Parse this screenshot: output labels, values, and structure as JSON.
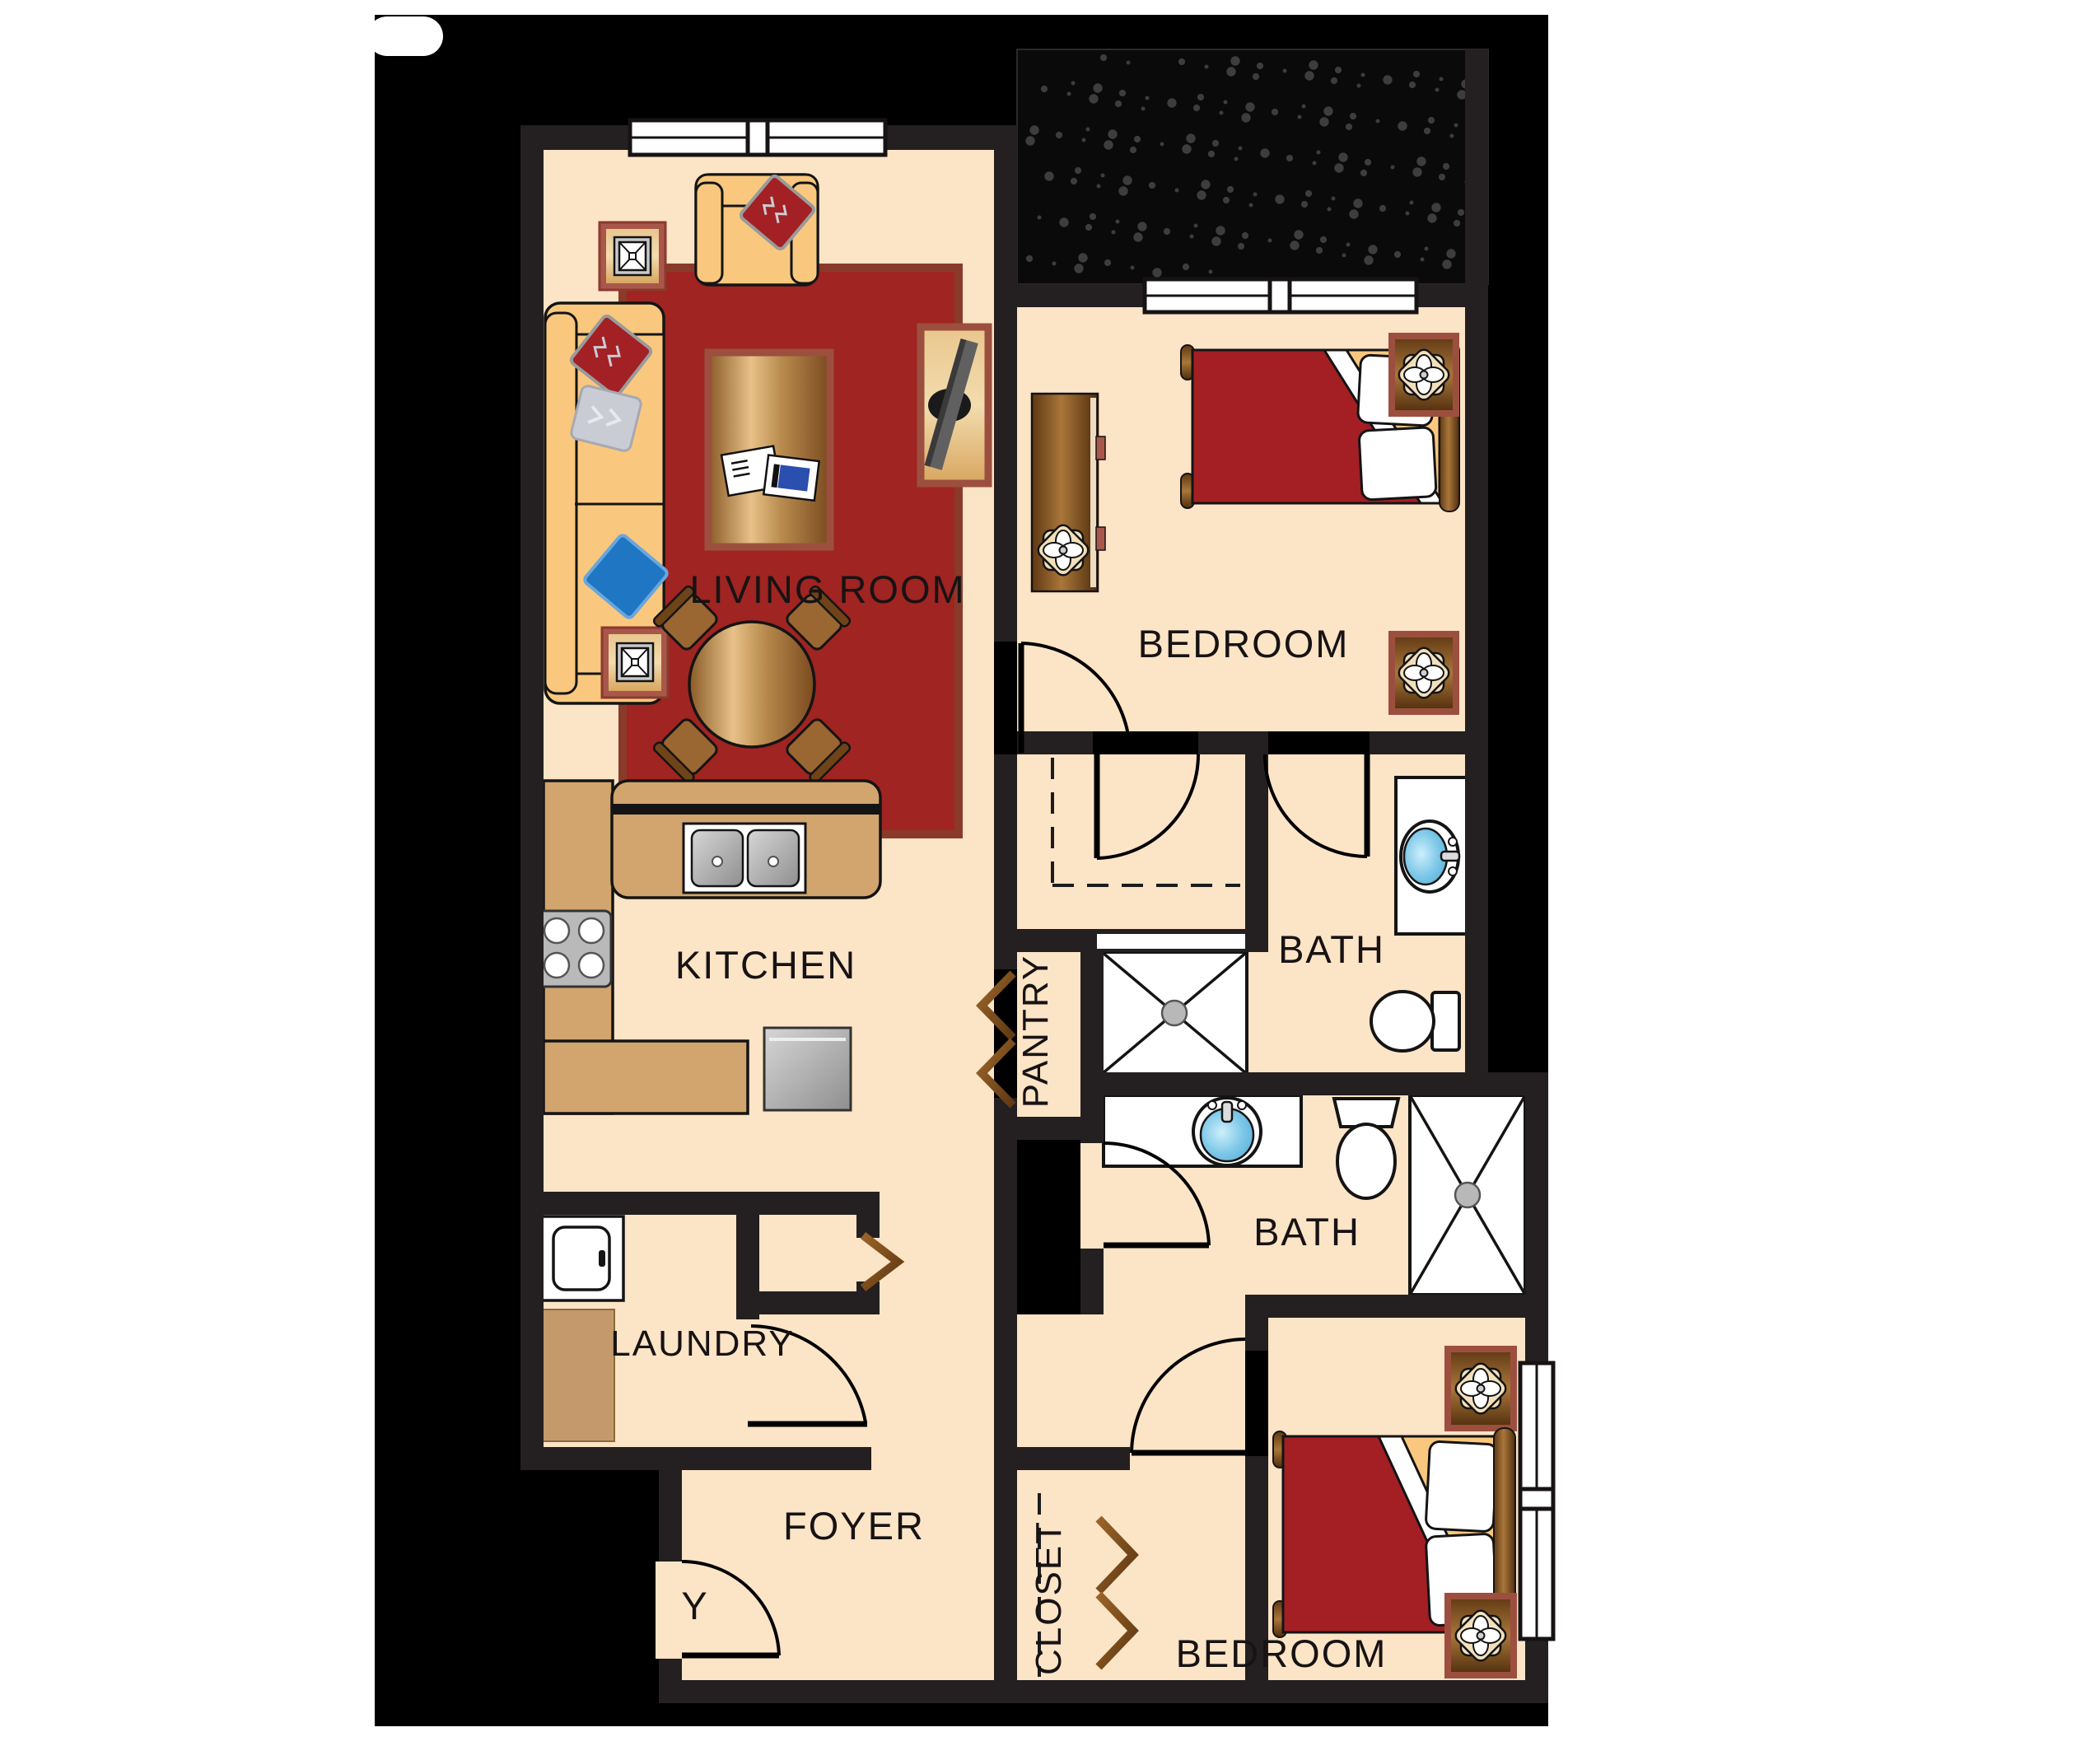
{
  "document": {
    "type": "apartment floor plan",
    "bedrooms_shown": 2,
    "baths_shown": 2
  },
  "rooms": {
    "living_room": "LIVING ROOM",
    "bedroom_top": "BEDROOM",
    "bedroom_bottom": "BEDROOM",
    "bath_top": "BATH",
    "bath_bottom": "BATH",
    "kitchen": "KITCHEN",
    "pantry": "PANTRY",
    "laundry": "LAUNDRY",
    "foyer": "FOYER",
    "closet": "CLOSET",
    "entry_label_visible_part": "Y"
  },
  "colors": {
    "canvas": "#ffffff",
    "backdrop": "#000000",
    "wall": "#241f20",
    "floor": "#fce4c6",
    "counter": "#d2a46e",
    "rug": "#a02421",
    "rug_border": "#8a3a2a",
    "bedspread": "#a31f24",
    "maroon_trim": "#9c4f3f",
    "sofa_tan": "#f9c87e",
    "pillow_red": "#a32024",
    "pillow_blue": "#1f77c4",
    "pillow_silver": "#c9ccd4",
    "sink_blue": "#7ec8e8",
    "appliance_gray": "#c0c0c0",
    "speckle": "#424242",
    "wood_dark": "#6b3d12",
    "wood_light": "#d9a86a"
  },
  "icons": [
    "sofa-icon",
    "armchair-icon",
    "end-table-lamp-icon",
    "coffee-table-icon",
    "tv-stand-icon",
    "dining-table-icon",
    "sink-icon",
    "stove-icon",
    "dishwasher-icon",
    "washer-icon",
    "bed-icon",
    "dresser-icon",
    "nightstand-flower-icon",
    "toilet-icon",
    "shower-icon",
    "vanity-sink-icon",
    "door-swing-icon",
    "bifold-door-icon",
    "window-icon",
    "closet-shelf-dashed-icon"
  ]
}
